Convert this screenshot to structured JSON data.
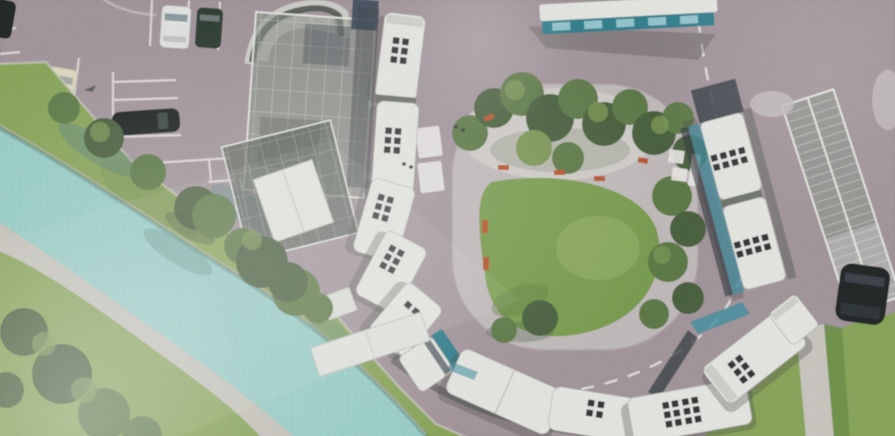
{
  "meta": {
    "kind": "photograph of a printed architectural rendering",
    "subject": "aerial bird's-eye site plan of a bus terminal turning loop beside a canal",
    "visible_text": "none"
  },
  "palette": {
    "road": "#a89aa1",
    "road_light": "#c6babe",
    "island_paving": "#c9c2c2",
    "island_plaza": "#dcd8d3",
    "lawn": "#7ca24e",
    "lawn_light": "#9cba68",
    "grass": "#8cab59",
    "grass_dark": "#6c9245",
    "tree_dark": "#46603a",
    "tree_mid": "#5d7c45",
    "tree_light": "#7e9c55",
    "water": "#9cd7d0",
    "water_shadow": "#58867f",
    "path": "#d2cec8",
    "marking": "#f4f2ee",
    "bus_roof": "#f1f2ec",
    "bus_roof_shade": "#d7d9d1",
    "bus_hatch": "#2f3231",
    "bus_gap": "#70756e",
    "bus_teal": "#2f8291",
    "bus_window": "#3f93a6",
    "canopy_glass": "#8d978b",
    "canopy_glass_dark": "#525e52",
    "canopy_frame": "#eef0ea",
    "bench": "#c0552a",
    "car_dark": "#1d2023",
    "car_white": "#eceded",
    "car_green": "#2a3a2f",
    "car_cream": "#e9e2c6",
    "shadow": "#474c49"
  },
  "scene": {
    "objects": [
      {
        "name": "river-canal",
        "desc": "turquoise canal running diagonally across the lower-left, tree shadows cast on water"
      },
      {
        "name": "riverside-footpath",
        "desc": "light paved path along the lower canal bank"
      },
      {
        "name": "grass-banks",
        "desc": "lawns with mature trees on both canal banks and lower-left corner"
      },
      {
        "name": "parking-lot",
        "desc": "car park upper-left with white painted stalls",
        "cars": [
          "dark car cropped at left edge",
          "white car",
          "dark-green car",
          "cream car",
          "dark car parked horizontally"
        ]
      },
      {
        "name": "west-station-canopy",
        "desc": "glazed station canopy with curved dark entrance band and bright white shelter roof"
      },
      {
        "name": "west-bus-stands",
        "desc": "queue of five white-roofed buses with dark roof hatches along the west side"
      },
      {
        "name": "south-articulated-bus",
        "desc": "articulated bus with teal front bending around the south curve"
      },
      {
        "name": "central-island",
        "desc": "rounded island with pale paved ring and plaza, central lawn, dense tree grove, seven orange benches"
      },
      {
        "name": "loop-road",
        "desc": "one-way loop around the island with white dashed lane line"
      },
      {
        "name": "crosswalk-west",
        "desc": "zebra bars west of the island"
      },
      {
        "name": "crosswalk-east",
        "desc": "zebra bars east of the island"
      },
      {
        "name": "east-platform",
        "desc": "long glazed ladder-rib canopy with two articulated buses docked"
      },
      {
        "name": "southeast-articulated-bus",
        "desc": "articulated bus with blue glazing rounding the southeast curve"
      },
      {
        "name": "north-bus",
        "desc": "bus with teal window band cropped by the top edge"
      },
      {
        "name": "black-car-east",
        "desc": "dark car parked below the east canopy end"
      },
      {
        "name": "southeast-footpath",
        "desc": "pedestrian path leaving the loop through grass at lower right"
      },
      {
        "name": "pedestrians",
        "desc": "four tiny figures near the crossings"
      },
      {
        "name": "photo-artifacts",
        "desc": "paper glare highlights, washed-out low contrast, film grain, soft focus"
      }
    ]
  }
}
